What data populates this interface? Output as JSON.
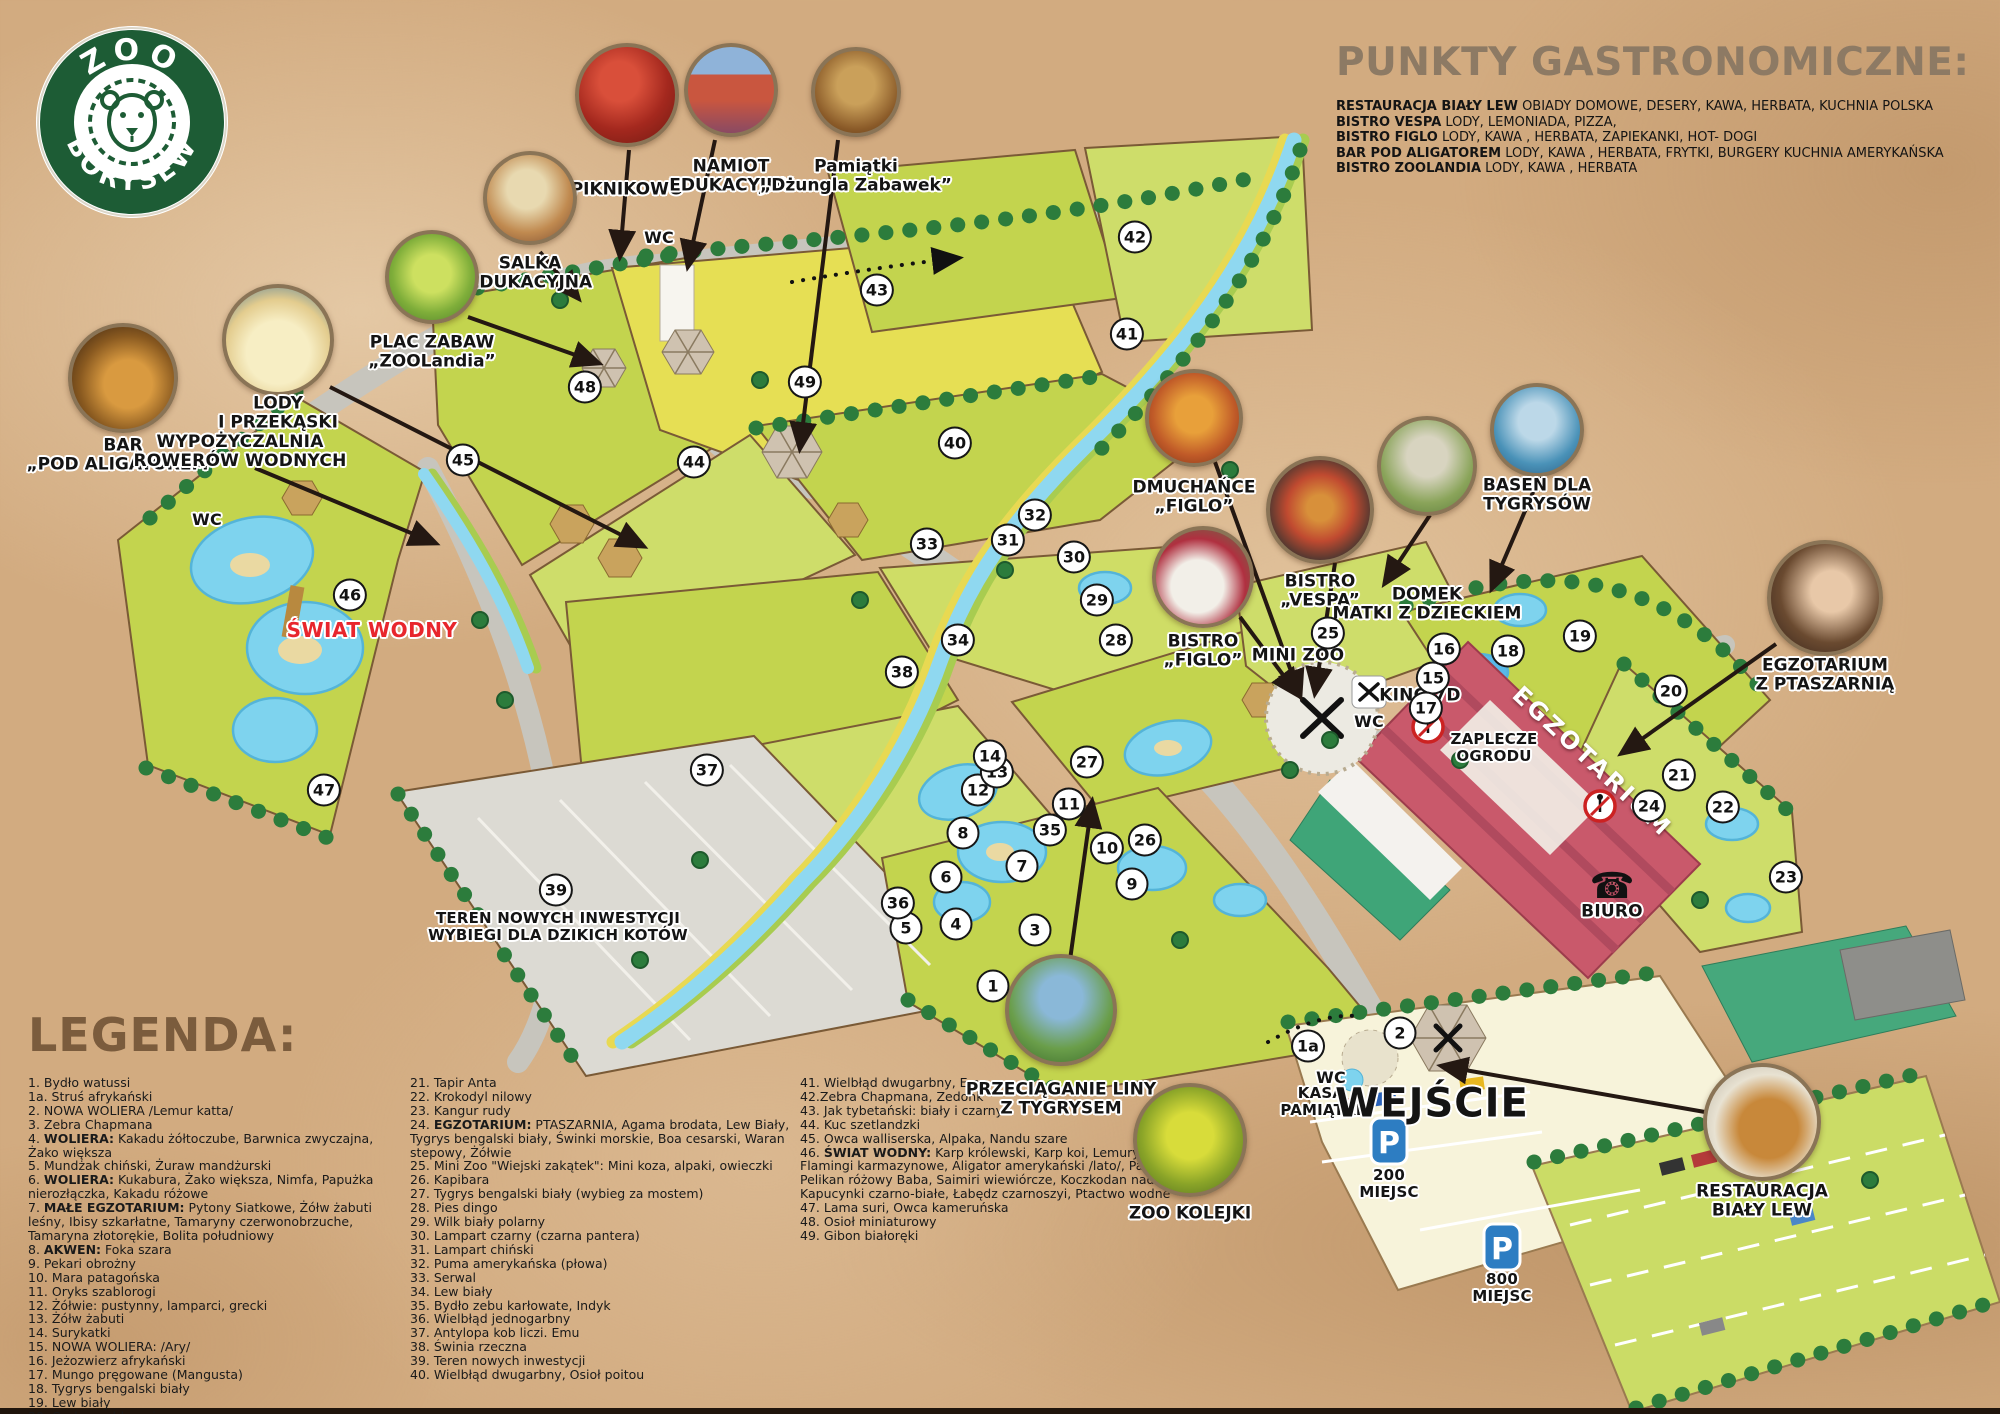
{
  "logo": {
    "top": "ZOO",
    "bottom": "BORYSEW"
  },
  "gastro": {
    "title": "PUNKTY GASTRONOMICZNE:",
    "items": [
      {
        "name": "RESTAURACJA BIAŁY LEW",
        "desc": " OBIADY DOMOWE, DESERY, KAWA, HERBATA, KUCHNIA POLSKA"
      },
      {
        "name": "BISTRO VESPA",
        "desc": "  LODY, LEMONIADA, PIZZA,"
      },
      {
        "name": "BISTRO FIGLO",
        "desc": " LODY, KAWA , HERBATA, ZAPIEKANKI, HOT- DOGI"
      },
      {
        "name": "BAR POD ALIGATOREM",
        "desc": " LODY, KAWA , HERBATA, FRYTKI, BURGERY KUCHNIA AMERYKAŃSKA"
      },
      {
        "name": "BISTRO ZOOLANDIA",
        "desc": " LODY, KAWA , HERBATA"
      }
    ]
  },
  "legend": {
    "title": "LEGENDA:",
    "col1": [
      "1. Bydło watussi",
      "1a.   Struś afrykański",
      "2. NOWA WOLIERA /Lemur katta/",
      "3. Zebra Chapmana",
      "4.  **WOLIERA:** Kakadu żółtoczube, Barwnica zwyczajna, Żako większa",
      "5. Mundżak chiński, Żuraw mandżurski",
      "6. **WOLIERA:** Kukabura, Żako większa, Nimfa, Papużka nierozłączka,  Kakadu różowe",
      "7. **MAŁE EGZOTARIUM:** Pytony Siatkowe, Żółw żabuti leśny, Ibisy szkarłatne, Tamaryny czerwonobrzuche, Tamaryna złotorękie, Bolita południowy",
      "8. **AKWEN:** Foka szara",
      "9. Pekari obrożny",
      "10. Mara patagońska",
      "11. Oryks szablorogi",
      "12. Żółwie: pustynny, lamparci, grecki",
      "13. Żółw żabuti",
      "14. Surykatki",
      "15. NOWA WOLIERA: /Ary/",
      "16. Jeżozwierz afrykański",
      "17. Mungo pręgowane (Mangusta)",
      "18. Tygrys bengalski biały",
      "19. Lew biały",
      "20. Oryks szablorogi"
    ],
    "col2": [
      "21. Tapir Anta",
      "22. Krokodyl nilowy",
      "23. Kangur rudy",
      "24. **EGZOTARIUM:** PTASZARNIA, Agama brodata, Lew Biały, Tygrys bengalski biały, Świnki morskie, Boa cesarski, Waran stepowy, Żółwie",
      "25. Mini Zoo \"Wiejski zakątek\": Mini koza, alpaki, owieczki",
      "26. Kapibara",
      "27. Tygrys bengalski biały (wybieg za mostem)",
      "28. Pies dingo",
      "29. Wilk biały polarny",
      "30. Lampart czarny (czarna pantera)",
      "31. Lampart chiński",
      "32. Puma amerykańska (płowa)",
      "33. Serwal",
      "34. Lew biały",
      "35. Bydło zebu karłowate, Indyk",
      "36. Wielbłąd jednogarbny",
      "37. Antylopa kob liczi. Emu",
      "38. Świnia rzeczna",
      "39. Teren nowych inwestycji",
      "40. Wielbłąd dwugarbny, Osioł poitou"
    ],
    "col3": [
      "41. Wielbłąd dwugarbny, Emu",
      "42.Zebra Chapmana, Zedonk",
      "43. Jak tybetański: biały i czarny",
      "44. Kuc szetlandzki",
      "45. Owca walliserska, Alpaka, Nandu szare",
      "46.  **ŚWIAT WODNY:**  Karp królewski, Karp koi, Lemury katta, Flamingi karmazynowe, Aligator amerykański /lato/, Paw królewski, Pelikan różowy Baba, Saimiri wiewiórcze, Koczkodan nadobny, Kapucynki czarno-białe, Łabędz czarnoszyi, Ptactwo wodne",
      "47. Lama suri, Owca kameruńska",
      "48. Osioł miniaturowy",
      "49. Gibon białoręki"
    ]
  },
  "map": {
    "p": "P",
    "badges": [
      {
        "n": "1a",
        "x": 1308,
        "y": 1046
      },
      {
        "n": "1",
        "x": 993,
        "y": 986
      },
      {
        "n": "2",
        "x": 1400,
        "y": 1033
      },
      {
        "n": "3",
        "x": 1035,
        "y": 930
      },
      {
        "n": "4",
        "x": 956,
        "y": 924
      },
      {
        "n": "5",
        "x": 906,
        "y": 928
      },
      {
        "n": "6",
        "x": 946,
        "y": 877
      },
      {
        "n": "7",
        "x": 1022,
        "y": 866
      },
      {
        "n": "8",
        "x": 963,
        "y": 833
      },
      {
        "n": "9",
        "x": 1132,
        "y": 884
      },
      {
        "n": "10",
        "x": 1107,
        "y": 848
      },
      {
        "n": "11",
        "x": 1069,
        "y": 804
      },
      {
        "n": "12",
        "x": 978,
        "y": 790
      },
      {
        "n": "13",
        "x": 997,
        "y": 772
      },
      {
        "n": "14",
        "x": 990,
        "y": 756
      },
      {
        "n": "15",
        "x": 1433,
        "y": 678
      },
      {
        "n": "16",
        "x": 1444,
        "y": 649
      },
      {
        "n": "17",
        "x": 1426,
        "y": 708
      },
      {
        "n": "18",
        "x": 1508,
        "y": 651
      },
      {
        "n": "19",
        "x": 1580,
        "y": 636
      },
      {
        "n": "20",
        "x": 1671,
        "y": 691
      },
      {
        "n": "21",
        "x": 1679,
        "y": 775
      },
      {
        "n": "22",
        "x": 1723,
        "y": 807
      },
      {
        "n": "23",
        "x": 1786,
        "y": 877
      },
      {
        "n": "24",
        "x": 1649,
        "y": 806
      },
      {
        "n": "25",
        "x": 1328,
        "y": 633
      },
      {
        "n": "26",
        "x": 1145,
        "y": 840
      },
      {
        "n": "27",
        "x": 1087,
        "y": 762
      },
      {
        "n": "28",
        "x": 1116,
        "y": 640
      },
      {
        "n": "29",
        "x": 1097,
        "y": 600
      },
      {
        "n": "30",
        "x": 1074,
        "y": 557
      },
      {
        "n": "31",
        "x": 1008,
        "y": 540
      },
      {
        "n": "32",
        "x": 1035,
        "y": 515
      },
      {
        "n": "33",
        "x": 927,
        "y": 544
      },
      {
        "n": "34",
        "x": 958,
        "y": 640
      },
      {
        "n": "35",
        "x": 1050,
        "y": 830
      },
      {
        "n": "36",
        "x": 898,
        "y": 903
      },
      {
        "n": "37",
        "x": 707,
        "y": 770
      },
      {
        "n": "38",
        "x": 902,
        "y": 672
      },
      {
        "n": "39",
        "x": 556,
        "y": 890
      },
      {
        "n": "40",
        "x": 955,
        "y": 443
      },
      {
        "n": "41",
        "x": 1127,
        "y": 334
      },
      {
        "n": "42",
        "x": 1135,
        "y": 237
      },
      {
        "n": "43",
        "x": 877,
        "y": 290
      },
      {
        "n": "44",
        "x": 694,
        "y": 462
      },
      {
        "n": "45",
        "x": 463,
        "y": 460
      },
      {
        "n": "46",
        "x": 350,
        "y": 595
      },
      {
        "n": "47",
        "x": 324,
        "y": 790
      },
      {
        "n": "48",
        "x": 585,
        "y": 387
      },
      {
        "n": "49",
        "x": 805,
        "y": 382
      }
    ],
    "labels": [
      {
        "t": "ŚWIAT WODNY",
        "x": 372,
        "y": 630,
        "s": "accent"
      },
      {
        "t": "WC",
        "x": 207,
        "y": 520,
        "s": "wc"
      },
      {
        "t": "WC",
        "x": 659,
        "y": 238,
        "s": "wc"
      },
      {
        "t": "WC",
        "x": 1369,
        "y": 722,
        "s": "wc"
      },
      {
        "t": "WC",
        "x": 1331,
        "y": 1078,
        "s": "wc"
      },
      {
        "t": "MINI ZOO",
        "x": 1298,
        "y": 656,
        "s": "lg"
      },
      {
        "t": "KINO 7D",
        "x": 1420,
        "y": 696,
        "s": "lg"
      },
      {
        "t": "ZAPLECZE\nOGRODU",
        "x": 1494,
        "y": 748,
        "s": "md"
      },
      {
        "t": "BIURO",
        "x": 1612,
        "y": 912,
        "s": "lg"
      },
      {
        "t": "EGZOTARIUM",
        "x": 1592,
        "y": 762,
        "s": "bldg",
        "r": 43
      },
      {
        "t": "KASA\nPAMIĄTKI",
        "x": 1321,
        "y": 1102,
        "s": "md"
      },
      {
        "t": "WEJŚCIE",
        "x": 1432,
        "y": 1104,
        "s": "huge"
      },
      {
        "t": "200\nMIEJSC",
        "x": 1389,
        "y": 1184,
        "s": "md"
      },
      {
        "t": "800\nMIEJSC",
        "x": 1502,
        "y": 1288,
        "s": "md"
      },
      {
        "t": "TEREN NOWYCH INWESTYCJI\nWYBIEGI DLA DZIKICH KOTÓW",
        "x": 558,
        "y": 927,
        "s": "md"
      },
      {
        "t": "WYPOŻYCZALNIA\nROWERÓW WODNYCH",
        "x": 240,
        "y": 452,
        "s": "lg"
      }
    ],
    "callouts": [
      {
        "key": "piknikowo",
        "label": "PIKNIKOWO",
        "cx": 627,
        "cy": 95,
        "r": 48,
        "ly": 190
      },
      {
        "key": "namiot",
        "label": "NAMIOT\nEDUKACYJNY",
        "cx": 731,
        "cy": 90,
        "r": 43,
        "ly": 177
      },
      {
        "key": "pamiatki",
        "label": "Pamiątki\n„Dżungla Zabawek”",
        "cx": 856,
        "cy": 92,
        "r": 41,
        "ly": 177
      },
      {
        "key": "salka",
        "label": "SALKA\nEDUKACYJNA",
        "cx": 530,
        "cy": 198,
        "r": 43,
        "ly": 274
      },
      {
        "key": "plac",
        "label": "PLAC ZABAW\n„ZOOLandia”",
        "cx": 432,
        "cy": 277,
        "r": 43,
        "ly": 353
      },
      {
        "key": "lody",
        "label": "LODY\nI PRZEKĄSKI",
        "cx": 278,
        "cy": 340,
        "r": 52,
        "ly": 414
      },
      {
        "key": "bar",
        "label": "BAR\n„POD ALIGATOREM”",
        "cx": 123,
        "cy": 378,
        "r": 51,
        "ly": 456
      },
      {
        "key": "dmuchance",
        "label": "DMUCHAŃCE\n„FIGLO”",
        "cx": 1194,
        "cy": 418,
        "r": 45,
        "ly": 498
      },
      {
        "key": "vespa",
        "label": "BISTRO\n„VESPA”",
        "cx": 1320,
        "cy": 510,
        "r": 50,
        "ly": 592
      },
      {
        "key": "figlo",
        "label": "BISTRO\n„FIGLO”",
        "cx": 1203,
        "cy": 577,
        "r": 47,
        "ly": 652
      },
      {
        "key": "domek",
        "label": "DOMEK\nMATKI Z DZIECKIEM",
        "cx": 1427,
        "cy": 466,
        "r": 46,
        "ly": 605
      },
      {
        "key": "basen",
        "label": "BASEN DLA\nTYGRYSÓW",
        "cx": 1537,
        "cy": 430,
        "r": 43,
        "ly": 496
      },
      {
        "key": "ptaszarnia",
        "label": "EGZOTARIUM\nZ PTASZARNIĄ",
        "cx": 1825,
        "cy": 598,
        "r": 54,
        "ly": 676
      },
      {
        "key": "tug",
        "label": "PRZECIĄGANIE LINY\nZ TYGRYSEM",
        "cx": 1061,
        "cy": 1010,
        "r": 52,
        "ly": 1100
      },
      {
        "key": "kolejka",
        "label": "ZOO KOLEJKI",
        "cx": 1190,
        "cy": 1140,
        "r": 53,
        "ly": 1214
      },
      {
        "key": "restauracja",
        "label": "RESTAURACJA\nBIAŁY LEW",
        "cx": 1762,
        "cy": 1122,
        "r": 55,
        "ly": 1202
      }
    ]
  }
}
